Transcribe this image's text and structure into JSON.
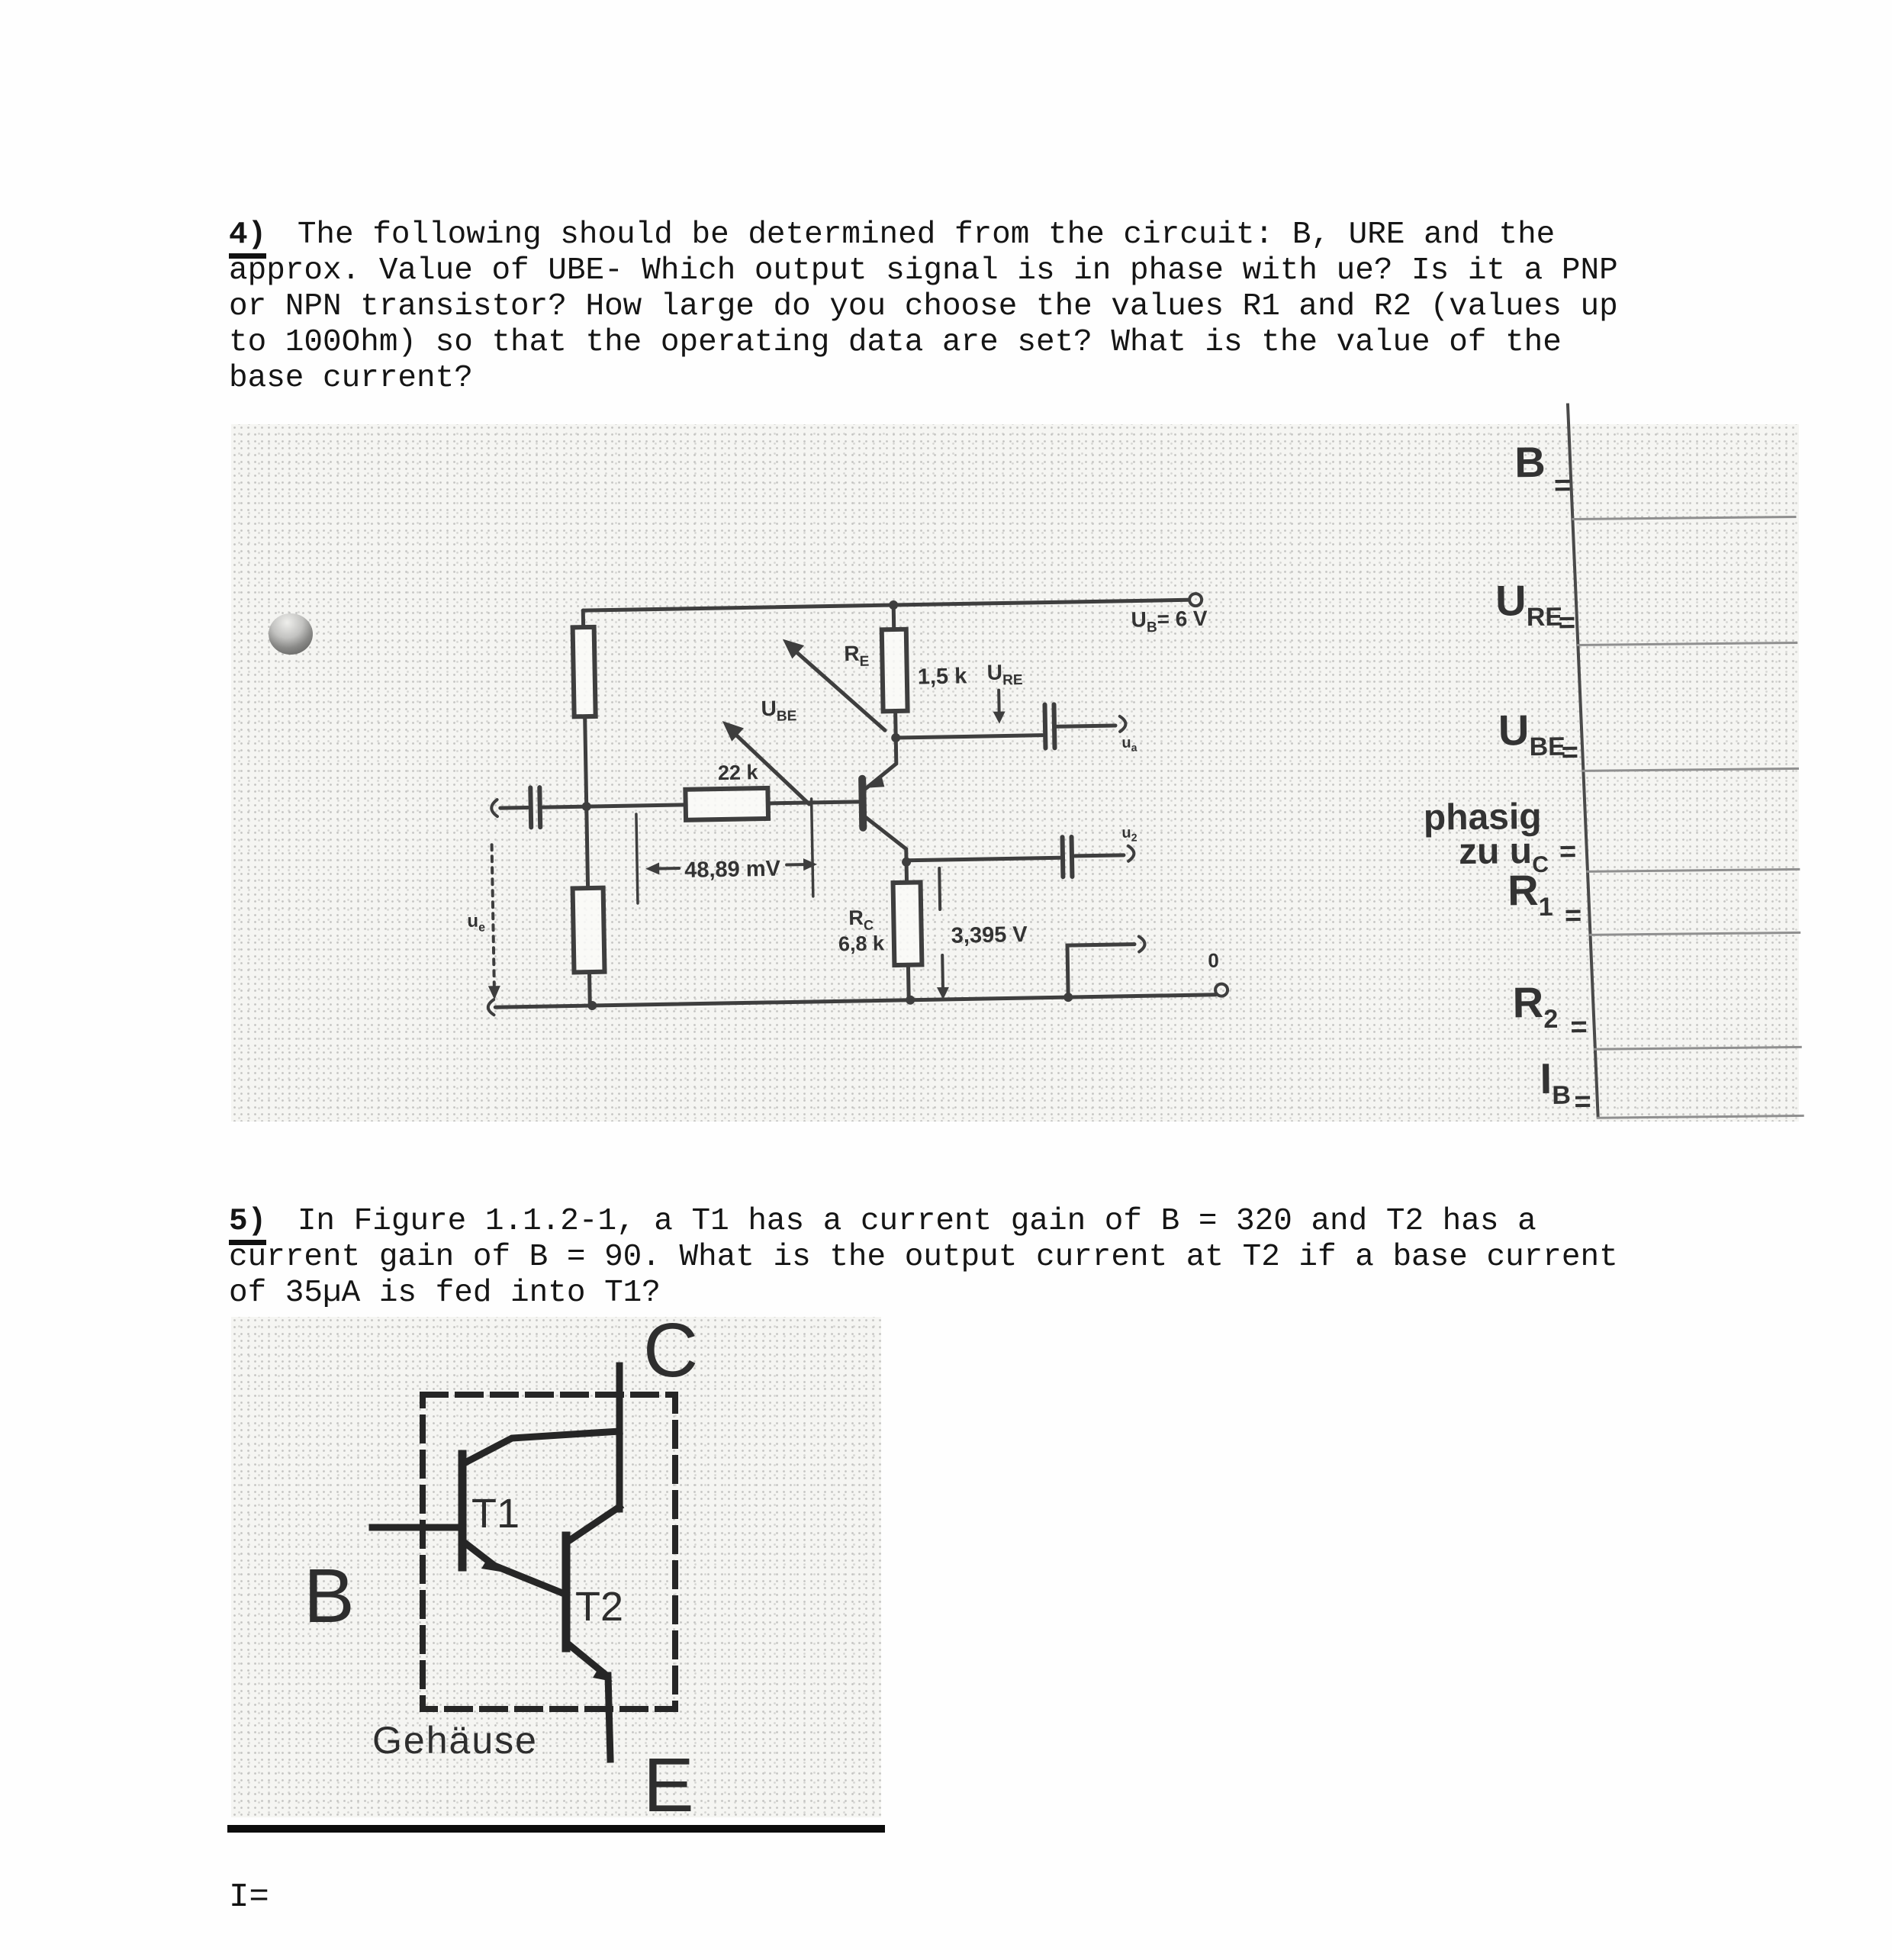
{
  "q4": {
    "number": "4)",
    "lines": [
      " The following should be determined from the circuit: B, URE and the",
      "approx. Value of UBE- Which output signal is in phase with ue? Is it a PNP",
      "or NPN transistor? How large do you choose the values R1 and R2 (values up",
      "to 100Ohm) so that the operating data are set? What is the value of the",
      "base current?"
    ]
  },
  "q5": {
    "number": "5)",
    "lines": [
      " In Figure 1.1.2-1, a T1 has a current gain of B = 320 and T2 has a",
      "current gain of B = 90. What is the output current at T2 if a base current",
      "of 35µA is fed into T1?"
    ]
  },
  "circuit": {
    "supply_main": "U",
    "supply_sub": "B",
    "supply_rest": "= 6 V",
    "re_main": "R",
    "re_sub": "E",
    "re_value": "1,5 k",
    "ure_main": "U",
    "ure_sub": "RE",
    "ube_main": "U",
    "ube_sub": "BE",
    "rb_value": "22 k",
    "mv_dim": "48,89 mV",
    "rc_main": "R",
    "rc_sub": "C",
    "rc_value": "6,8 k",
    "vc": "3,395 V",
    "zero": "0",
    "ue_main": "u",
    "ue_sub": "e",
    "out1_main": "u",
    "out1_sub": "a",
    "out2_main": "u",
    "out2_sub": "2"
  },
  "answers": {
    "rows": [
      {
        "main": "B",
        "sub": "",
        "eq": "="
      },
      {
        "main": "U",
        "sub": "RE",
        "eq": "="
      },
      {
        "main": "U",
        "sub": "BE",
        "eq": "="
      },
      {
        "pre": "phasig",
        "main": "zu u",
        "sub": "C",
        "eq": "="
      },
      {
        "main": "R",
        "sub": "1",
        "eq": "="
      },
      {
        "main": "R",
        "sub": "2",
        "eq": "="
      },
      {
        "main": "I",
        "sub": "B",
        "eq": "="
      }
    ]
  },
  "fig5": {
    "c": "C",
    "b": "B",
    "e": "E",
    "t1": "T1",
    "t2": "T2",
    "case": "Gehäuse"
  },
  "result_label": "I=",
  "colors": {
    "ink": "#161616",
    "scan_background": "#f5f5f2",
    "circuit_line": "#3e3e3e"
  }
}
